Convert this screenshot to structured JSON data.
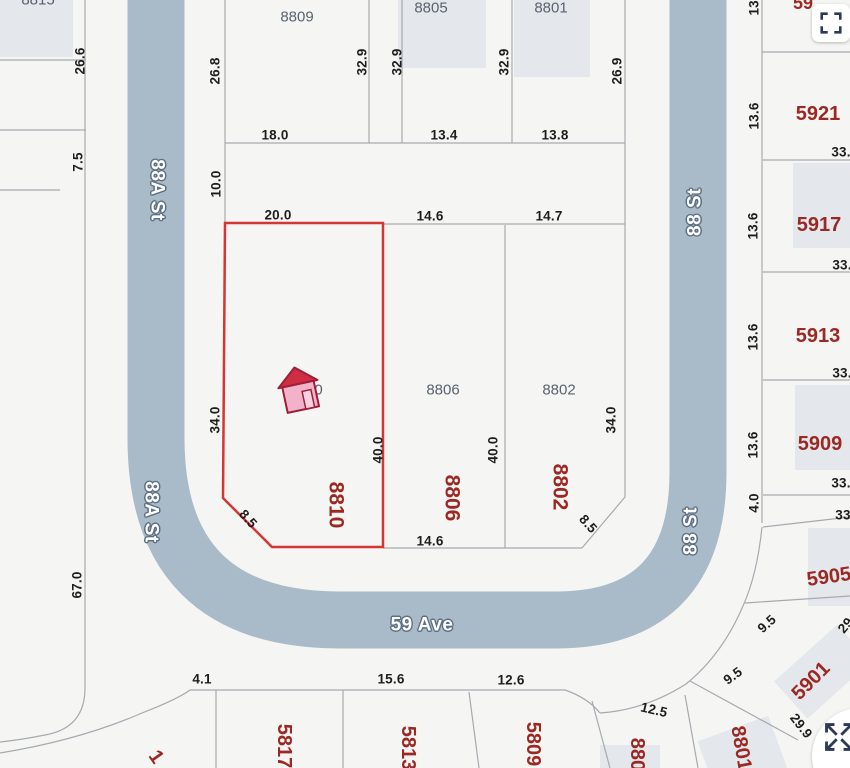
{
  "map": {
    "background": "#f5f5f3",
    "road_color": "#a9bbc9",
    "parcel_line_color": "#a6aab0",
    "building_footprint_color": "#e4e7eb",
    "highlight_outline_color": "#d43535",
    "dimension_text_color": "#1e1e1e",
    "address_gray_color": "#59626e",
    "address_red_color": "#9c2823",
    "street_label_outline_color": "#5d7085",
    "streets": [
      {
        "t": "88A St",
        "x": 157,
        "y": 190,
        "rot": 90
      },
      {
        "t": "88A St",
        "x": 151,
        "y": 512,
        "rot": 90
      },
      {
        "t": "88 St",
        "x": 695,
        "y": 212,
        "rot": -90
      },
      {
        "t": "88 St",
        "x": 691,
        "y": 531,
        "rot": -90
      },
      {
        "t": "59 Ave",
        "x": 422,
        "y": 625,
        "rot": 0
      }
    ],
    "gray_addresses": [
      {
        "t": "8815",
        "x": 38,
        "y": 0
      },
      {
        "t": "8809",
        "x": 297,
        "y": 17
      },
      {
        "t": "8805",
        "x": 431,
        "y": 8
      },
      {
        "t": "8801",
        "x": 551,
        "y": 8
      },
      {
        "t": "8810",
        "x": 306,
        "y": 390
      },
      {
        "t": "8806",
        "x": 443,
        "y": 390
      },
      {
        "t": "8802",
        "x": 559,
        "y": 390
      }
    ],
    "red_addresses": [
      {
        "t": "8810",
        "x": 336,
        "y": 505,
        "rot": 90,
        "size": 21
      },
      {
        "t": "8806",
        "x": 452,
        "y": 498,
        "rot": 90,
        "size": 21
      },
      {
        "t": "8802",
        "x": 560,
        "y": 487,
        "rot": 90,
        "size": 21
      },
      {
        "t": "5921",
        "x": 818,
        "y": 114,
        "size": 20
      },
      {
        "t": "5917",
        "x": 819,
        "y": 225,
        "size": 20
      },
      {
        "t": "5913",
        "x": 818,
        "y": 336,
        "size": 20
      },
      {
        "t": "5909",
        "x": 820,
        "y": 444,
        "size": 20
      },
      {
        "t": "5905",
        "x": 829,
        "y": 577,
        "rot": -8,
        "size": 20
      },
      {
        "t": "5901",
        "x": 811,
        "y": 681,
        "rot": -45,
        "size": 20
      },
      {
        "t": "5817",
        "x": 284,
        "y": 746,
        "rot": 90,
        "size": 20
      },
      {
        "t": "5813",
        "x": 408,
        "y": 748,
        "rot": 90,
        "size": 20
      },
      {
        "t": "5809",
        "x": 533,
        "y": 744,
        "rot": 90,
        "size": 20
      },
      {
        "t": "8805",
        "x": 637,
        "y": 760,
        "rot": 90,
        "size": 20
      },
      {
        "t": "8801",
        "x": 741,
        "y": 748,
        "rot": 80,
        "size": 20
      },
      {
        "t": "1",
        "x": 156,
        "y": 757,
        "rot": 55,
        "size": 20
      },
      {
        "t": "59",
        "x": 803,
        "y": 3,
        "size": 18
      }
    ],
    "dimensions": [
      {
        "t": "26.6",
        "x": 80,
        "y": 61,
        "rot": -90
      },
      {
        "t": "7.5",
        "x": 78,
        "y": 162,
        "rot": -90
      },
      {
        "t": "67.0",
        "x": 77,
        "y": 585,
        "rot": -90
      },
      {
        "t": "26.8",
        "x": 215,
        "y": 71,
        "rot": -90
      },
      {
        "t": "10.0",
        "x": 216,
        "y": 184,
        "rot": -90
      },
      {
        "t": "32.9",
        "x": 362,
        "y": 62,
        "rot": -90
      },
      {
        "t": "32.9",
        "x": 397,
        "y": 62,
        "rot": -90
      },
      {
        "t": "32.9",
        "x": 504,
        "y": 62,
        "rot": -90
      },
      {
        "t": "26.9",
        "x": 617,
        "y": 71,
        "rot": -90
      },
      {
        "t": "34.0",
        "x": 215,
        "y": 420,
        "rot": -90
      },
      {
        "t": "34.0",
        "x": 611,
        "y": 420,
        "rot": -90
      },
      {
        "t": "40.0",
        "x": 378,
        "y": 450,
        "rot": -90
      },
      {
        "t": "40.0",
        "x": 493,
        "y": 450,
        "rot": -90
      },
      {
        "t": "13.6",
        "x": 754,
        "y": 2,
        "rot": -90
      },
      {
        "t": "13.6",
        "x": 754,
        "y": 116,
        "rot": -90
      },
      {
        "t": "13.6",
        "x": 753,
        "y": 226,
        "rot": -90
      },
      {
        "t": "13.6",
        "x": 753,
        "y": 337,
        "rot": -90
      },
      {
        "t": "13.6",
        "x": 753,
        "y": 445,
        "rot": -90
      },
      {
        "t": "4.0",
        "x": 754,
        "y": 503,
        "rot": -90
      },
      {
        "t": "18.0",
        "x": 275,
        "y": 135
      },
      {
        "t": "13.4",
        "x": 444,
        "y": 135
      },
      {
        "t": "13.8",
        "x": 555,
        "y": 135
      },
      {
        "t": "20.0",
        "x": 278,
        "y": 215
      },
      {
        "t": "14.6",
        "x": 430,
        "y": 216
      },
      {
        "t": "14.7",
        "x": 549,
        "y": 216
      },
      {
        "t": "14.6",
        "x": 430,
        "y": 541
      },
      {
        "t": "4.1",
        "x": 202,
        "y": 679
      },
      {
        "t": "15.6",
        "x": 391,
        "y": 679
      },
      {
        "t": "12.6",
        "x": 511,
        "y": 680
      },
      {
        "t": "33.",
        "x": 841,
        "y": 152
      },
      {
        "t": "33.",
        "x": 842,
        "y": 265
      },
      {
        "t": "33.",
        "x": 842,
        "y": 373
      },
      {
        "t": "33.",
        "x": 841,
        "y": 483
      },
      {
        "t": "33",
        "x": 843,
        "y": 515
      },
      {
        "t": "8.5",
        "x": 248,
        "y": 519,
        "rot": 48
      },
      {
        "t": "8.5",
        "x": 588,
        "y": 524,
        "rot": 48
      },
      {
        "t": "12.5",
        "x": 654,
        "y": 710,
        "rot": 13
      },
      {
        "t": "9.5",
        "x": 733,
        "y": 676,
        "rot": -36
      },
      {
        "t": "9.5",
        "x": 767,
        "y": 624,
        "rot": -42
      },
      {
        "t": "29.9",
        "x": 801,
        "y": 726,
        "rot": 52
      },
      {
        "t": "29.",
        "x": 847,
        "y": 624,
        "rot": -50
      }
    ],
    "highlighted_lot": {
      "address": "8810",
      "marker": "house-icon"
    }
  },
  "controls": {
    "fullscreen_button_icon": "fullscreen-icon",
    "expand_button_icon": "expand-arrows-icon"
  }
}
